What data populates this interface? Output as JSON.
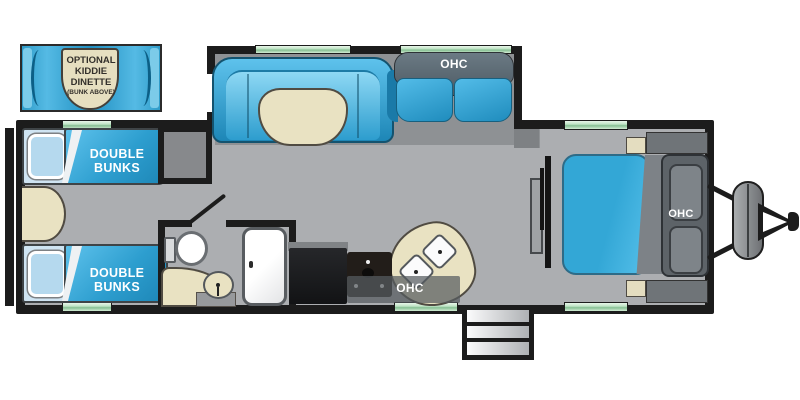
{
  "callout_dinette": {
    "line1": "OPTIONAL",
    "line2": "KIDDIE",
    "line3": "DINETTE",
    "line4": "(BUNK ABOVE)"
  },
  "bunk_room": {
    "top_bunk_label": "DOUBLE BUNKS",
    "bottom_bunk_label": "DOUBLE BUNKS"
  },
  "living_area": {
    "sofa_overhead_cabinet_label": "OHC"
  },
  "kitchen": {
    "overhead_cabinet_label": "OHC"
  },
  "bedroom": {
    "overhead_cabinet_label": "OHC"
  },
  "colors": {
    "furniture_blue": "#2D9ECF",
    "upholstery_cream": "#E9E2C2",
    "floor_gray": "#ACAEB1",
    "slideout_floor_gray": "#8E9194",
    "wall_black": "#1C1C1C",
    "window_green": "#A8D8AE"
  }
}
